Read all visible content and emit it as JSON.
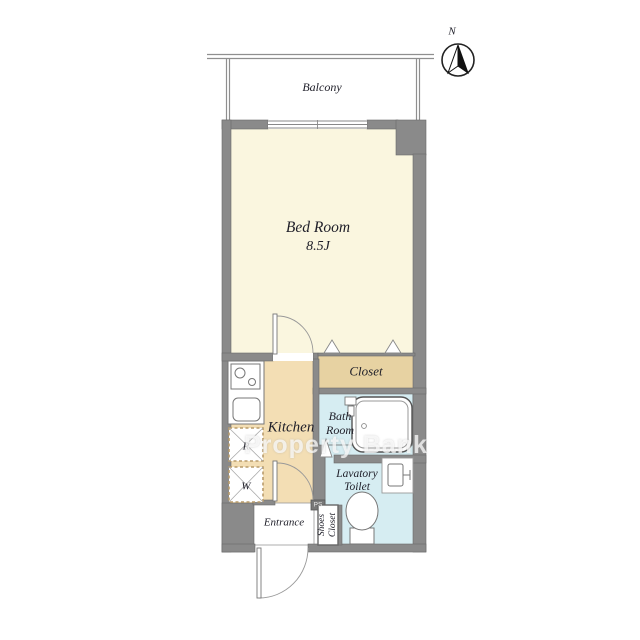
{
  "plan": {
    "north_label": "N",
    "watermark": "Property Bank",
    "rooms": {
      "balcony": {
        "label": "Balcony"
      },
      "bedroom": {
        "label": "Bed Room",
        "size": "8.5J"
      },
      "closet": {
        "label": "Closet"
      },
      "kitchen": {
        "label": "Kitchen"
      },
      "bathroom": {
        "label": "Bath Room"
      },
      "lavatory": {
        "label": "Lavatory Toilet"
      },
      "entrance": {
        "label": "Entrance"
      },
      "shoes_closet": {
        "label": "Shoes Closet"
      },
      "pipe_space": {
        "label": "PS"
      }
    },
    "fixtures": {
      "refrigerator": {
        "label": "R"
      },
      "washer": {
        "label": "W"
      }
    },
    "colors": {
      "wall": "#8A8A8A",
      "bedroom_floor": "#FAF6DF",
      "kitchen_floor": "#F3DEB4",
      "closet_floor": "#E7D2A2",
      "wet_area_floor": "#D6EDF2"
    }
  }
}
